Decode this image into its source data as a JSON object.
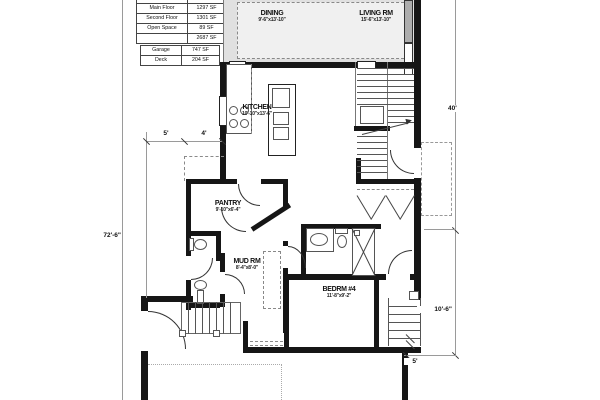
{
  "area_tables": {
    "main": {
      "headers": {
        "name": "NAME",
        "area": "AREA"
      },
      "rows": [
        [
          "Main Floor",
          "1297 SF"
        ],
        [
          "Second Floor",
          "1301 SF"
        ],
        [
          "Open Space",
          "89 SF"
        ],
        [
          "",
          "2687 SF"
        ]
      ]
    },
    "secondary": {
      "rows": [
        [
          "Garage",
          "747 SF"
        ],
        [
          "Deck",
          "204 SF"
        ]
      ]
    }
  },
  "rooms": {
    "dining": {
      "name": "DINING",
      "size": "9'-6\"x13'-10\""
    },
    "living": {
      "name": "LIVING RM",
      "size": "15'-6\"x13'-10\""
    },
    "kitchen": {
      "name": "KITCHEN",
      "size": "10'-10\"x13'-6\""
    },
    "pantry": {
      "name": "PANTRY",
      "size": "9'-10\"x6'-4\""
    },
    "mud": {
      "name": "MUD RM",
      "size": "8'-4\"x8'-0\""
    },
    "bed4": {
      "name": "BEDRM #4",
      "size": "11'-8\"x9'-2\""
    }
  },
  "dimensions": {
    "overall_height": "72'-6\"",
    "upper_right": "40'",
    "lower_right": "10'-6\"",
    "offset_a": "5'",
    "offset_b": "4'",
    "deck_width": "5'"
  },
  "colors": {
    "wall": "#161616",
    "deck_fill": "#e0e0e0",
    "glazing": "#adadad"
  }
}
